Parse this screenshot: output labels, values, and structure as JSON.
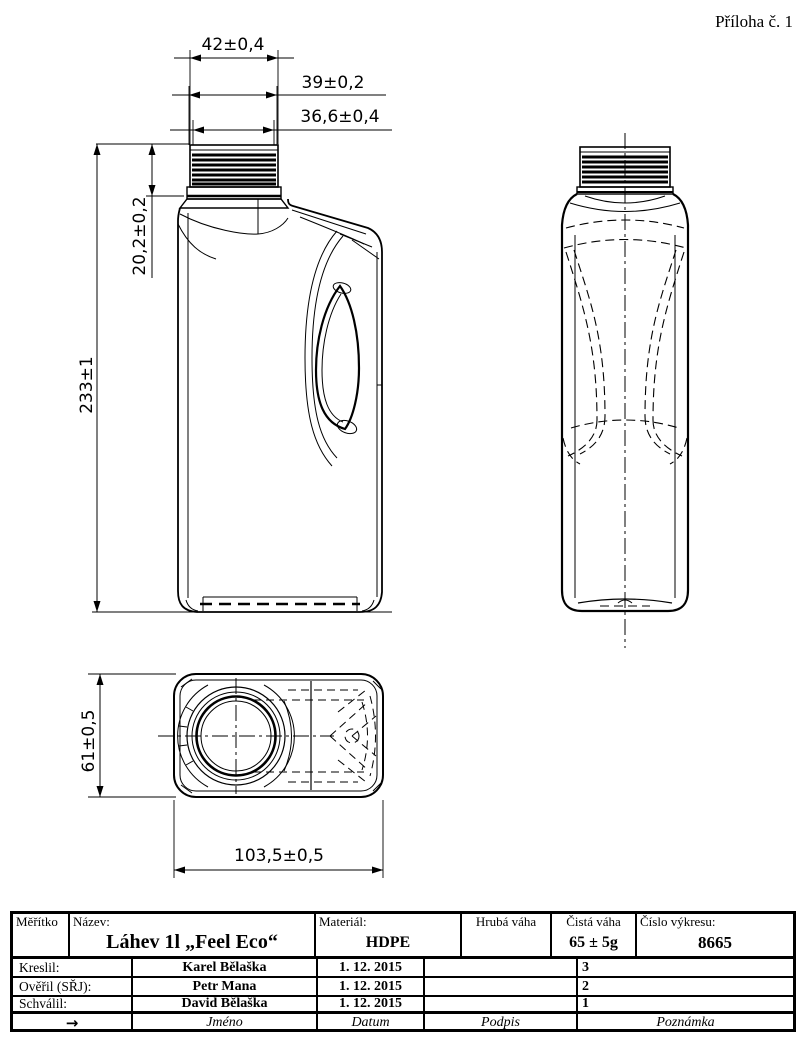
{
  "page": {
    "annotation": "Příloha č. 1"
  },
  "dimensions": {
    "cap_outer": "42±0,4",
    "cap_mid": "39±0,2",
    "thread": "36,6±0,4",
    "neck_height": "20,2±0,2",
    "total_height": "233±1",
    "depth": "61±0,5",
    "width": "103,5±0,5"
  },
  "title_block": {
    "scale_label": "Měřítko",
    "name_label": "Název:",
    "name_value": "Láhev 1l „Feel Eco“",
    "material_label": "Materiál:",
    "material_value": "HDPE",
    "gross_weight_label": "Hrubá váha",
    "gross_weight_value": "",
    "net_weight_label": "Čistá váha",
    "net_weight_value": "65 ± 5g",
    "drawing_number_label": "Číslo výkresu:",
    "drawing_number_value": "8665",
    "rows": [
      {
        "role": "Kreslil:",
        "name": "Karel Bělaška",
        "date": "1. 12. 2015",
        "signature": "",
        "revision": "3"
      },
      {
        "role": "Ověřil (SŘJ):",
        "name": "Petr Mana",
        "date": "1. 12. 2015",
        "signature": "",
        "revision": "2"
      },
      {
        "role": "Schválil:",
        "name": "David Bělaška",
        "date": "1. 12. 2015",
        "signature": "",
        "revision": "1"
      }
    ],
    "footer": {
      "arrow": "→",
      "name_col": "Jméno",
      "date_col": "Datum",
      "signature_col": "Podpis",
      "note_col": "Poznámka"
    }
  }
}
